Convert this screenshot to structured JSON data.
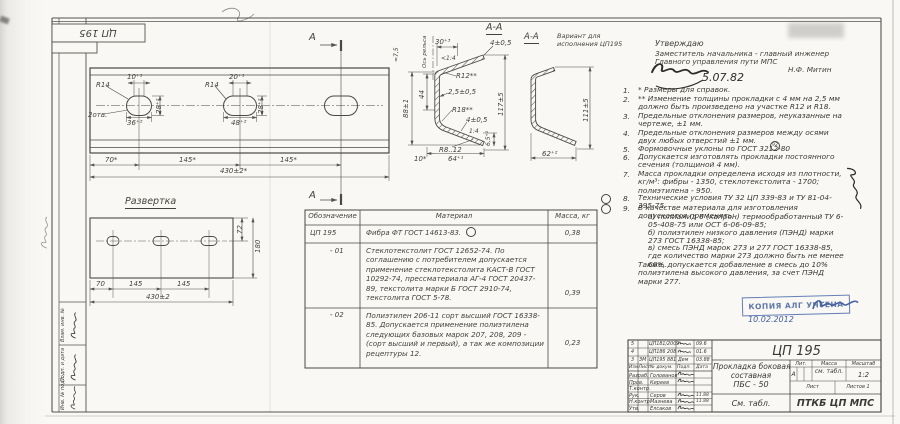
{
  "stamp_top": "ЦП 195",
  "approval": {
    "line1": "Утверждаю",
    "line2": "Заместитель начальника - главный инженер",
    "line3": "Главного управления пути МПС",
    "name": "Н.Ф. Митин",
    "date": "5.07.82"
  },
  "notes": [
    {
      "num": "1.",
      "text": "* Размеры для справок."
    },
    {
      "num": "2.",
      "text": "** Изменение толщины прокладки с 4 мм на 2,5 мм должно быть произведено на участке R12 и R18."
    },
    {
      "num": "3.",
      "text": "Предельные отклонения размеров, неуказанные на чертеже, ±1 мм."
    },
    {
      "num": "4.",
      "text": "Предельные отклонения размеров между осями двух любых отверстий ±1 мм."
    },
    {
      "num": "5.",
      "text": "Формовочные уклоны по ГОСТ 3212-80"
    },
    {
      "num": "6.",
      "text": "Допускается изготовлять прокладки постоянного сечения (толщиной 4 мм)."
    },
    {
      "num": "7.",
      "text": "Масса прокладки определена исходя из плотности, кг/м³: фибры - 1350, стеклотекстолита - 1700; полиэтилена - 950."
    },
    {
      "num": "8.",
      "text": "Технические условия ТУ 32 ЦП 339-83 и ТУ 81-04-395-75."
    },
    {
      "num": "9.",
      "text": "В качестве материала для изготовления допускается применять:"
    }
  ],
  "note5_mark": "92",
  "notes_sub": [
    "а) полиамид 6 (капрон) термообработанный ТУ 6-05-408-75 или ОСТ 6-06-09-85;",
    "б) полиэтилен низкого давления (ПЭНД) марки 273 ГОСТ 16338-85;",
    "в) смесь ПЭНД марок 273 и 277 ГОСТ 16338-85, где количество марки 273 должно быть не менее 60%."
  ],
  "notes_tail": "Также, допускается добавление в смесь до 10% полиэтилена высокого давления, за счет ПЭНД марки 277.",
  "plate": {
    "r14a": "R14",
    "holes": "2отв.",
    "d10": "10⁺¹",
    "d28a": "28⁺²",
    "d36": "36⁺²",
    "r14b": "R14",
    "d20": "20⁺¹",
    "d28b": "28⁺²",
    "d48": "48⁺²",
    "d70": "70*",
    "d145a": "145*",
    "d145b": "145*",
    "d430": "430±2*",
    "cut_label": "А"
  },
  "razvertka": {
    "title": "Развертка",
    "d72": "72",
    "d180": "180",
    "d70": "70",
    "d145a": "145",
    "d145b": "145",
    "d430": "430±2"
  },
  "section": {
    "title": "А-А",
    "d75": "≈7,5",
    "axis": "Ось рельса",
    "d30": "30⁺³",
    "slope_top": "<1:4",
    "d4top": "4±0,5",
    "r12": "R12**",
    "d25": "2,5±0,5",
    "d44": "44",
    "d88": "88±1",
    "d117": "117±5",
    "r18": "R18**",
    "d4bot": "4±0,5",
    "slope_bot": "1:4",
    "d65": "6,5⁺²",
    "r8": "R8..12",
    "d10": "10*",
    "d64": "64⁺¹"
  },
  "variant": {
    "title": "А-А",
    "sub1": "Вариант для",
    "sub2": "исполнения ЦП195",
    "d111": "111±5",
    "d62": "62⁺²"
  },
  "table": {
    "headers": [
      "Обозначение",
      "Материал",
      "Масса, кг"
    ],
    "rows": [
      {
        "code": "ЦП 195",
        "material": "Фибра  ФТ ГОСТ 14613-83.",
        "mass": "0,38"
      },
      {
        "code": "- 01",
        "material": "Стеклотекстолит ГОСТ 12652-74. По соглашению с потребителем допускается применение стеклотекстолита КАСТ-В ГОСТ 10292-74, прессматериала АГ-4 ГОСТ 20437-89, текстолита марки Б ГОСТ 2910-74, текстолита ГОСТ 5-78.",
        "mass": "0,39"
      },
      {
        "code": "- 02",
        "material": "Полиэтилен 206-11 сорт высший ГОСТ 16338-85. Допускается применение полиэтилена следующих базовых марок 207, 208, 209 - (сорт высший и первый), а так же композиции рецептуры 12.",
        "mass": "0,23"
      }
    ]
  },
  "stamp_blue": {
    "text": "КОПИЯ АЛГ УЧТЕНА",
    "date": "10.02.2012"
  },
  "titleblock": {
    "doc_number": "ЦП 195",
    "name1": "Прокладка боковая",
    "name2": "составная",
    "name3": "ПБС - 50",
    "lit_label": "Лит.",
    "lit": "А",
    "mass_label": "Масса",
    "mass": "см. табл.",
    "scale_label": "Масштаб",
    "scale": "1:2",
    "sheet_label": "Лист",
    "sheets_label": "Листов 1",
    "material_ref": "См. табл.",
    "org": "ПТКБ ЦП МПС",
    "cols": [
      "Изм",
      "Лист",
      "№ докум.",
      "Подп.",
      "Дата"
    ],
    "staff": [
      {
        "role": "Разраб.",
        "name": "Голованов",
        "date": ""
      },
      {
        "role": "Пров.",
        "name": "Киреев",
        "date": ""
      },
      {
        "role": "Т.контр.",
        "name": "",
        "date": ""
      },
      {
        "role": "Рук.",
        "name": "Серов",
        "date": "11.88"
      },
      {
        "role": "Н.контр.",
        "name": "Мазнева",
        "date": "11.88"
      },
      {
        "role": "Утв.",
        "name": "Елсаков",
        "date": ""
      }
    ],
    "revisions": [
      {
        "izm": "5",
        "list": "",
        "doc": "ЦП181/2009",
        "podp": "",
        "date": "09.6"
      },
      {
        "izm": "4",
        "list": "",
        "doc": "ЦП186 208",
        "podp": "",
        "date": "01.6"
      },
      {
        "izm": "3",
        "list": "ЗМ",
        "doc": "ЦП195 881",
        "podp": "Дем",
        "date": "03.88"
      }
    ]
  },
  "margin": {
    "box1": "Взам. инв. №",
    "box2": "Подп. и дата",
    "box3": "Инв. № подл."
  }
}
